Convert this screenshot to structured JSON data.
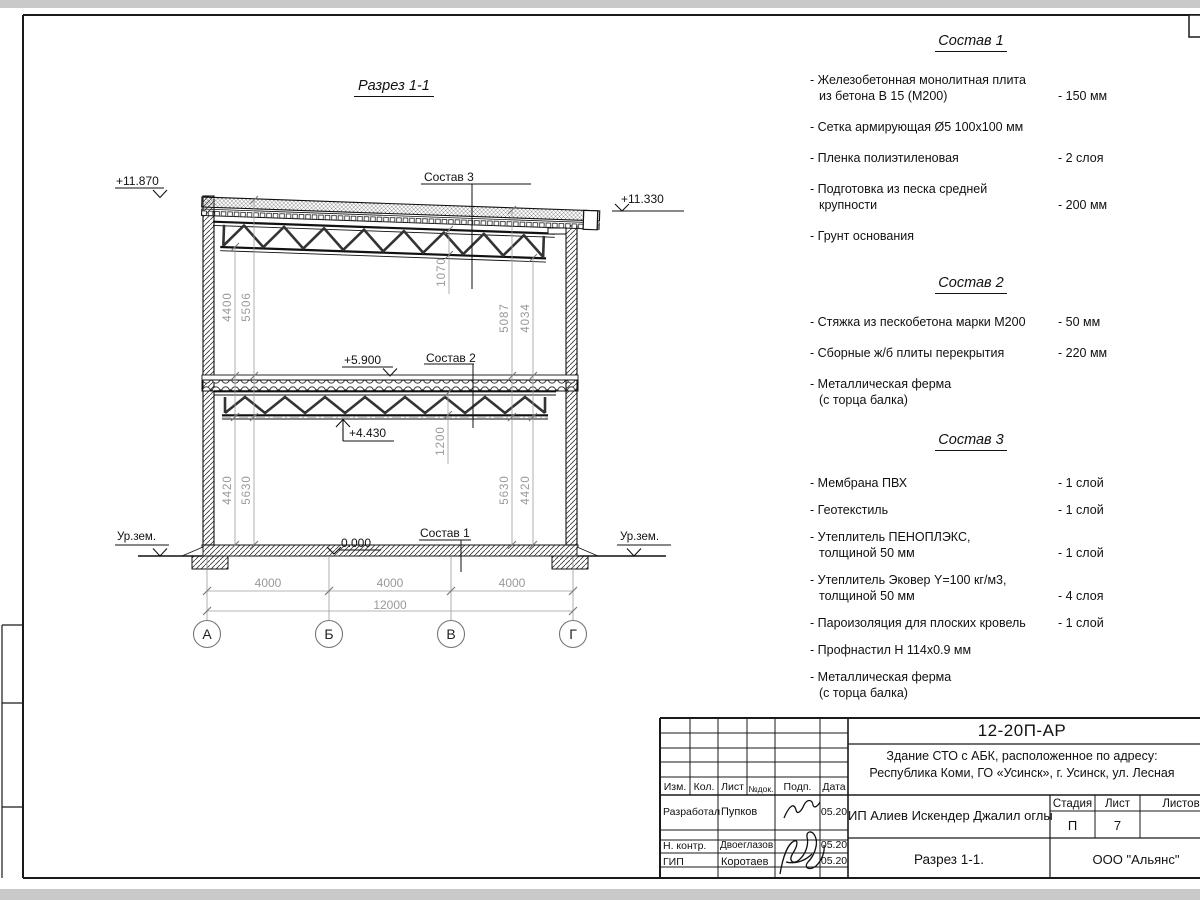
{
  "page": {
    "section_title": "Разрез 1-1"
  },
  "drawing": {
    "elevations": {
      "roof_left": "+11.870",
      "roof_right": "+11.330",
      "floor2": "+5.900",
      "truss2": "+4.430",
      "zero": "0.000",
      "ground_left": "Ур.зем.",
      "ground_right": "Ур.зем."
    },
    "callouts": {
      "sostav3": "Состав 3",
      "sostav2": "Состав 2",
      "sostav1": "Состав 1"
    },
    "dims": {
      "left_outer_top": "4400",
      "left_inner_top": "5506",
      "roof_truss_h": "1070",
      "right_inner_top": "5087",
      "right_outer_top": "4034",
      "floor_truss_h": "1200",
      "left_outer_bot": "4420",
      "left_inner_bot": "5630",
      "right_inner_bot": "5630",
      "right_outer_bot": "4420",
      "bay1": "4000",
      "bay2": "4000",
      "bay3": "4000",
      "total": "12000"
    },
    "axes": {
      "a1": "А",
      "a2": "Б",
      "a3": "В",
      "a4": "Г"
    }
  },
  "sostav1": {
    "title": "Состав 1",
    "items": [
      {
        "l1": "- Железобетонная  монолитная плита",
        "l2": "из бетона В 15 (М200)",
        "v": "- 150 мм"
      },
      {
        "l1": "- Сетка армирующая Ø5 100х100 мм",
        "l2": "",
        "v": ""
      },
      {
        "l1": "- Пленка полиэтиленовая",
        "l2": "",
        "v": "-  2 слоя"
      },
      {
        "l1": "- Подготовка из песка средней",
        "l2": "крупности",
        "v": "- 200 мм"
      },
      {
        "l1": "- Грунт основания",
        "l2": "",
        "v": ""
      }
    ]
  },
  "sostav2": {
    "title": "Состав 2",
    "items": [
      {
        "l1": "- Стяжка из пескобетона марки М200",
        "l2": "",
        "v": "- 50 мм"
      },
      {
        "l1": "- Сборные ж/б плиты перекрытия",
        "l2": "",
        "v": "- 220 мм"
      },
      {
        "l1": "- Металлическая ферма",
        "l2": "(с торца балка)",
        "v": ""
      }
    ]
  },
  "sostav3": {
    "title": "Состав 3",
    "items": [
      {
        "l1": "- Мембрана ПВХ",
        "l2": "",
        "v": "- 1 слой"
      },
      {
        "l1": "- Геотекстиль",
        "l2": "",
        "v": "- 1 слой"
      },
      {
        "l1": "- Утеплитель ПЕНОПЛЭКС,",
        "l2": "толщиной 50 мм",
        "v": "- 1 слой"
      },
      {
        "l1": "- Утеплитель Эковер Y=100 кг/м3,",
        "l2": "толщиной 50 мм",
        "v": "- 4 слоя"
      },
      {
        "l1": "- Пароизоляция для плоских кровель",
        "l2": "",
        "v": "- 1 слой"
      },
      {
        "l1": "- Профнастил Н 114х0.9 мм",
        "l2": "",
        "v": ""
      },
      {
        "l1": "- Металлическая ферма",
        "l2": "(с торца балка)",
        "v": ""
      }
    ]
  },
  "titleblock": {
    "doc_code": "12-20П-АР",
    "project_line1": "Здание СТО с АБК, расположенное по адресу:",
    "project_line2": "Республика Коми, ГО «Усинск», г. Усинск, ул. Лесная",
    "client": "ИП Алиев Искендер Джалил оглы",
    "drawing_name": "Разрез 1-1.",
    "company": "ООО \"Альянс\"",
    "stage_label": "Стадия",
    "sheet_label": "Лист",
    "sheets_label": "Листов",
    "stage": "П",
    "sheet": "7",
    "cols": {
      "izm": "Изм.",
      "kol": "Кол.",
      "list": "Лист",
      "ndok": "№док.",
      "podp": "Подп.",
      "data": "Дата"
    },
    "rows": [
      {
        "role": "Разработал",
        "name": "Пупков",
        "date": "05.20"
      },
      {
        "role": "Н. контр.",
        "name": "Двоеглазов",
        "date": "05.20"
      },
      {
        "role": "ГИП",
        "name": "Коротаев",
        "date": "05.20"
      }
    ]
  }
}
